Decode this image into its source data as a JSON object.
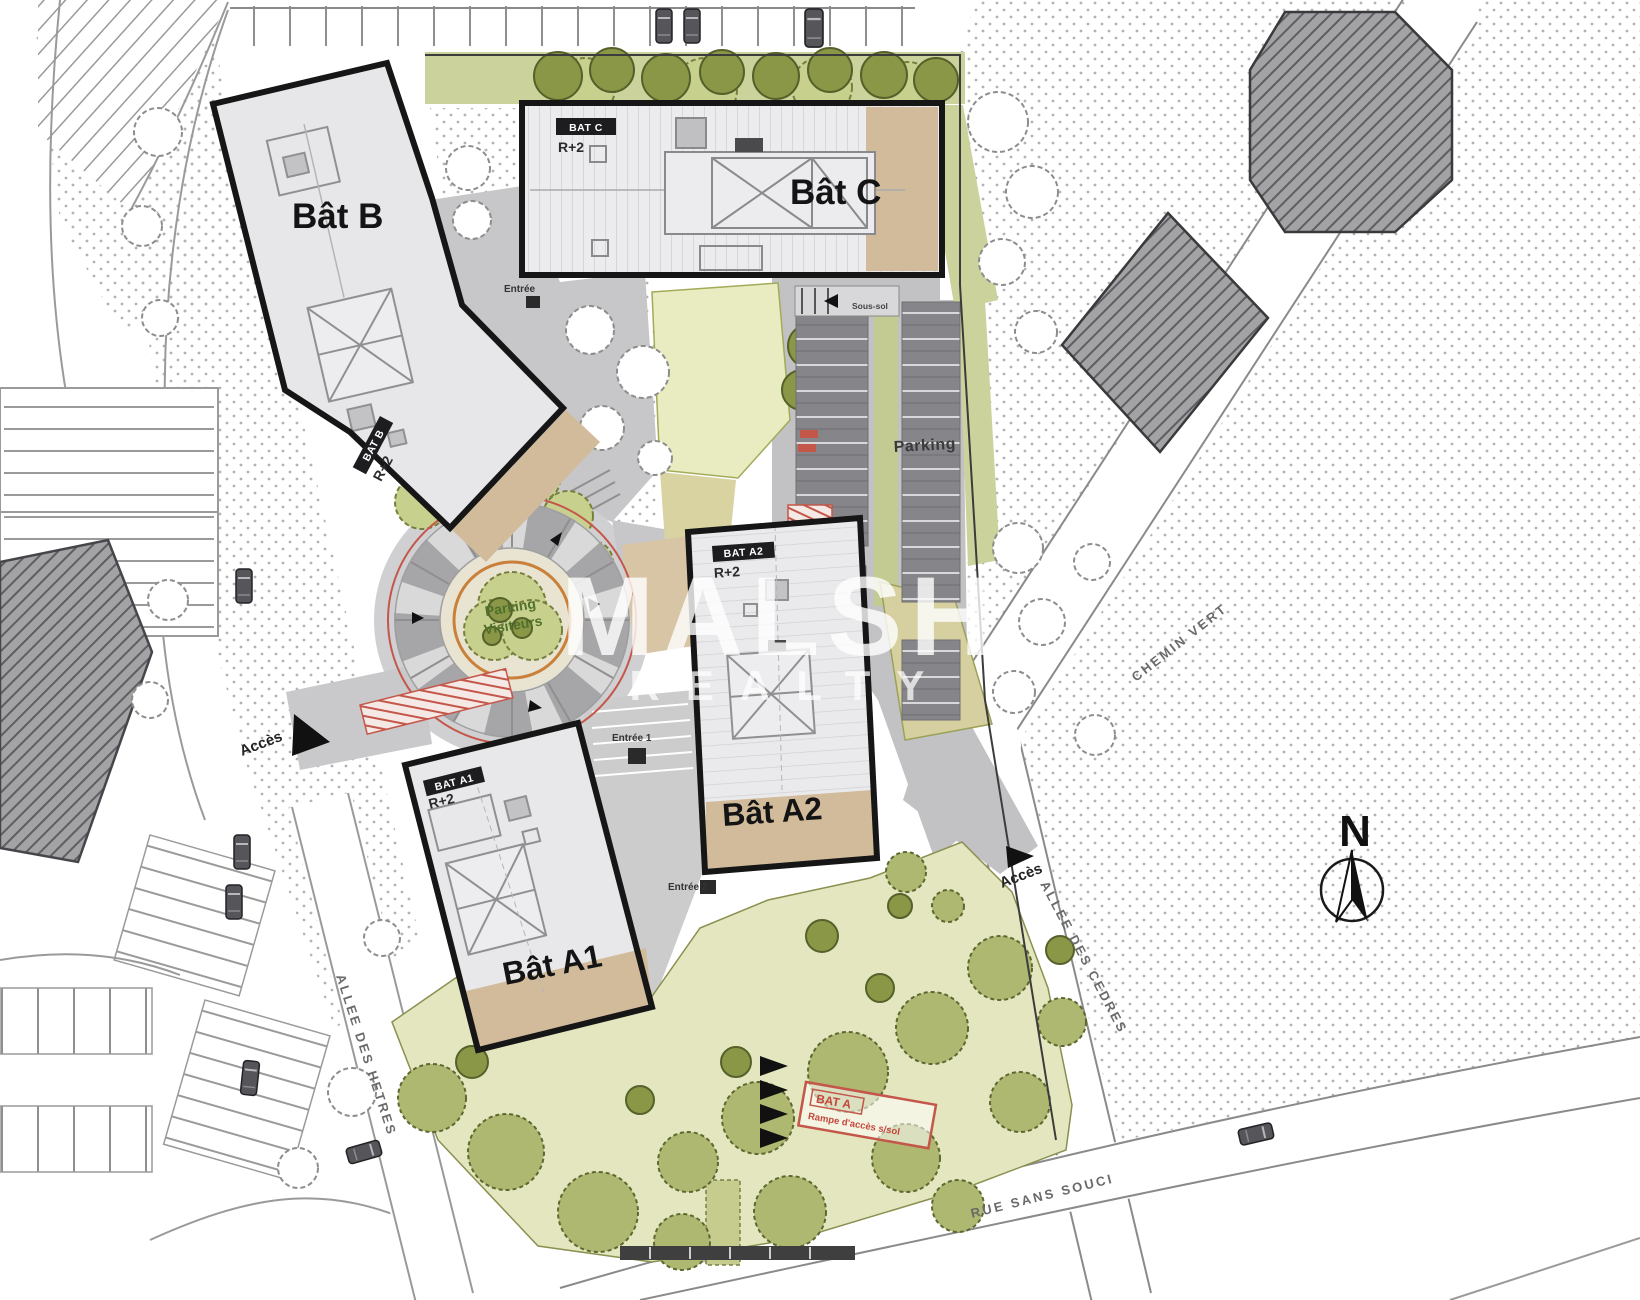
{
  "plan": {
    "buildings": [
      {
        "name": "Bât B",
        "tag": "BAT B",
        "level": "R+2"
      },
      {
        "name": "Bât C",
        "tag": "BAT C",
        "level": "R+2"
      },
      {
        "name": "Bât A1",
        "tag": "BAT A1",
        "level": "R+2"
      },
      {
        "name": "Bât A2",
        "tag": "BAT A2",
        "level": "R+2"
      }
    ],
    "labels": {
      "parking": "Parking",
      "visitors_line1": "Parking",
      "visitors_line2": "Visiteurs",
      "acces": "Accès",
      "sous_sol": "Sous-sol",
      "entree": "Entrée",
      "entree_1": "Entrée 1",
      "entree_2": "Entrée 2",
      "north": "N",
      "bat_a_line1": "BAT A",
      "bat_a_line2": "Rampe d'accès s/sol"
    },
    "streets": [
      {
        "name": "CHEMIN VERT"
      },
      {
        "name": "ALLEE DES CEDRES"
      },
      {
        "name": "ALLEE DES HETRES"
      },
      {
        "name": "RUE SANS SOUCI"
      }
    ],
    "watermark": {
      "line1": "MALSH",
      "line2": "REALTY"
    },
    "colors": {
      "building_outline": "#161616",
      "building_fill": "#e7e7e9",
      "terrace_tan": "#d2bb9b",
      "green_light": "#e4e6bf",
      "green_tree": "#aeb871",
      "path_gray": "#c7c7c9",
      "stall_gray": "#85858a",
      "red_accent": "#c4564a",
      "orange_ring": "#c9803a",
      "stipple_dot": "#9a9a9a"
    }
  }
}
